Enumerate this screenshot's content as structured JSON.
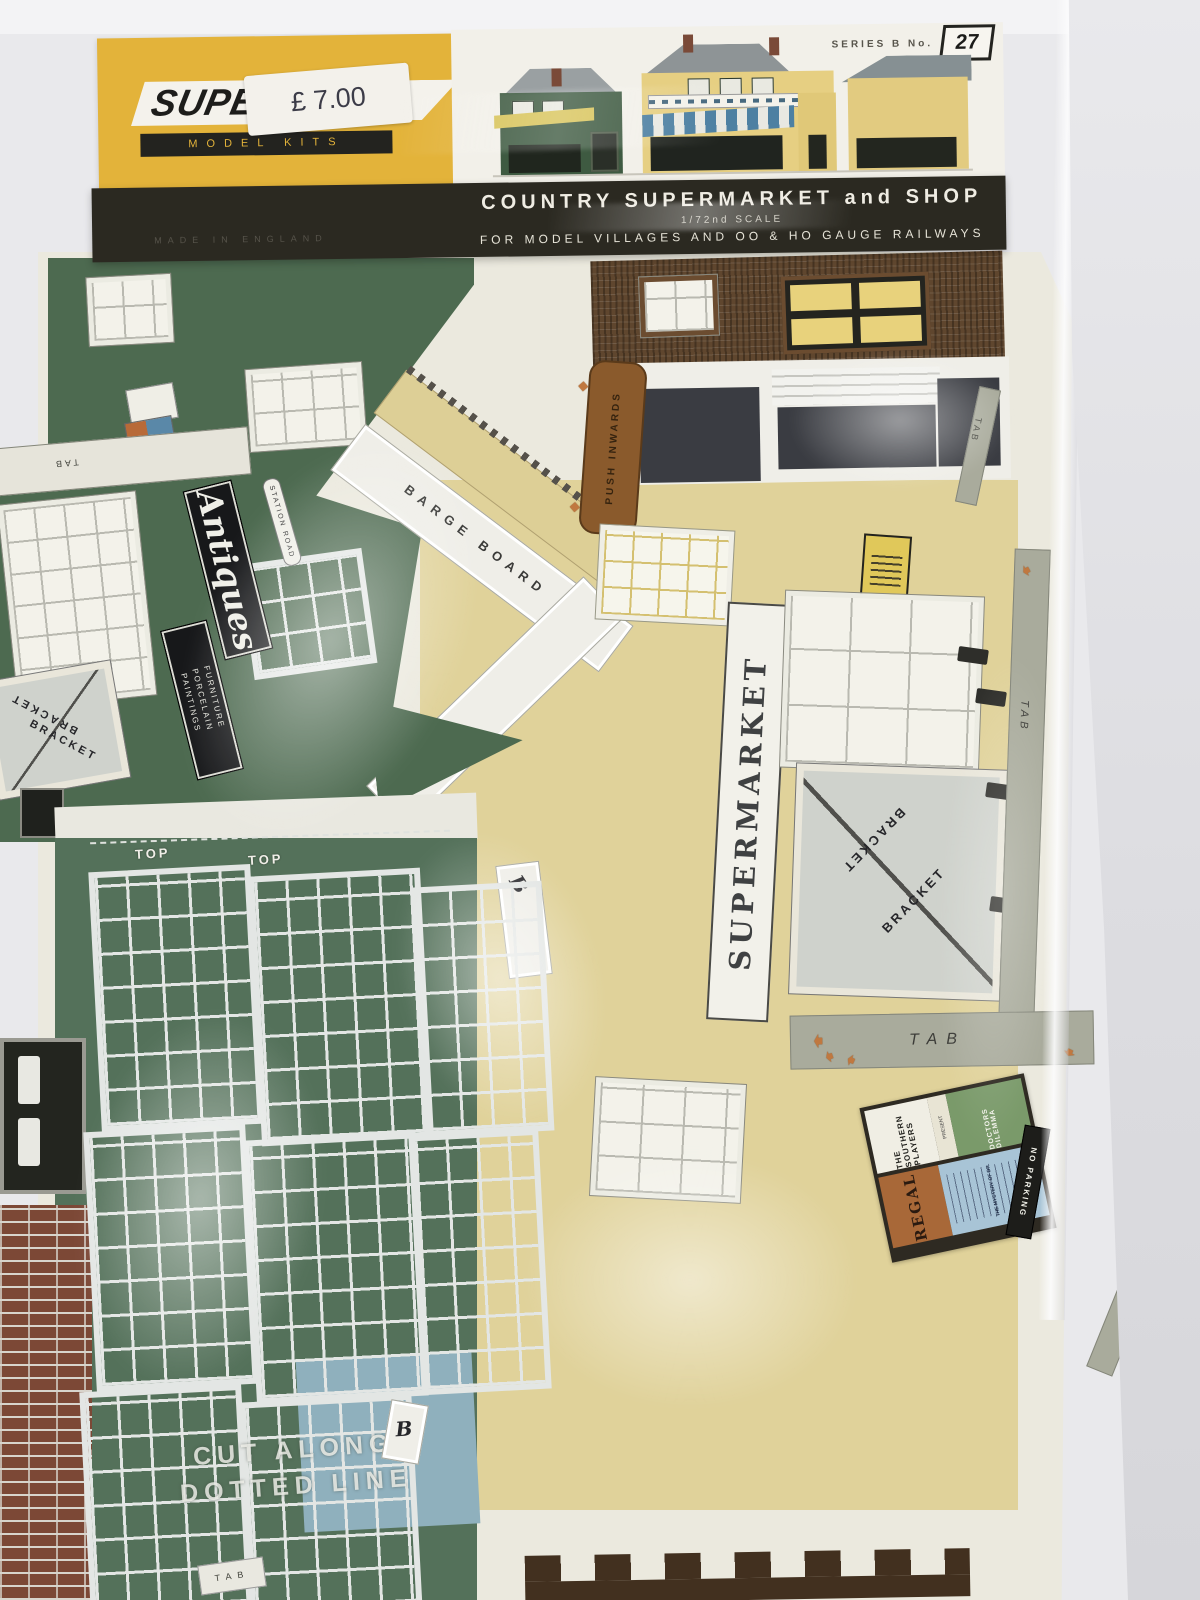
{
  "header": {
    "brand": "SUPER",
    "brand_sub": "MODEL KITS",
    "price": "£ 7.00",
    "made_in": "MADE IN ENGLAND",
    "series_label": "SERIES B No.",
    "series_number": "27",
    "title": "COUNTRY SUPERMARKET and SHOP",
    "scale_line": "1/72nd SCALE",
    "tagline": "FOR MODEL VILLAGES AND OO & HO GAUGE RAILWAYS"
  },
  "labels": {
    "antiques": "Antiques",
    "antiques_line1": "FURNITURE",
    "antiques_line2": "PORCELAIN",
    "antiques_line3": "PAINTINGS",
    "station_road": "STATION ROAD",
    "supermarket": "SUPERMARKET",
    "barge_board": "BARGE BOARD",
    "push_inwards": "PUSH INWARDS",
    "bracket": "BRACKET",
    "tab": "TAB",
    "top": "TOP",
    "letter_b": "B",
    "cut_line1": "CUT ALONG",
    "cut_line2": "DOTTED LINE"
  },
  "posters": {
    "players_name": "THE SOUTHERN PLAYERS",
    "players_present": "PRESENT",
    "players_show": "DOCTORS DILEMMA",
    "regal": "REGAL",
    "regal_film": "THE MYSTERY OF DR.",
    "no_parking": "NO PARKING"
  },
  "icons": {
    "arrow_glyph": "➧",
    "diamond_glyph": "◆"
  },
  "colors": {
    "card_yellow": "#e3b33a",
    "band_black": "#2b2921",
    "green_wall": "#4d6a50",
    "cream_wall": "#e0d29a",
    "brick_brown": "#5f462e",
    "brick_red": "#7c4836",
    "tab_grey": "#a9ab9c",
    "arrow_orange": "#c07840"
  }
}
